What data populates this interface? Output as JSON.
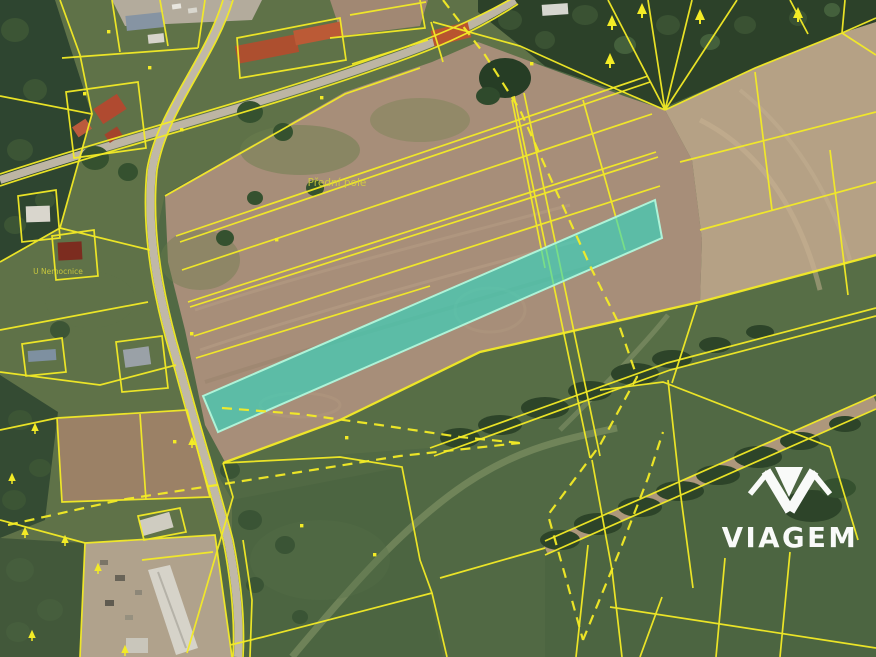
{
  "map": {
    "type": "cadastral-parcel-map-over-aerial-photo",
    "place_labels": [
      {
        "id": "field-name",
        "text": "Přední pole"
      },
      {
        "id": "street-name",
        "text": "U Nemocnice"
      }
    ],
    "highlighted_parcel": {
      "present": true,
      "shape": "long-narrow-strip"
    }
  },
  "watermark": {
    "brand": "VIAGEM"
  },
  "colors": {
    "parcel_line": "#f3eb26",
    "label_text": "#d8d43c",
    "highlight_fill": "#2fd8c2",
    "highlight_stroke": "#aef3d8",
    "watermark": "#ffffff",
    "grass": "#516944",
    "lawn": "#5f7248",
    "field_brown": "#a78e79",
    "field_tan": "#b5a185",
    "forest": "#2c4129",
    "road": "#bdb5a4"
  }
}
